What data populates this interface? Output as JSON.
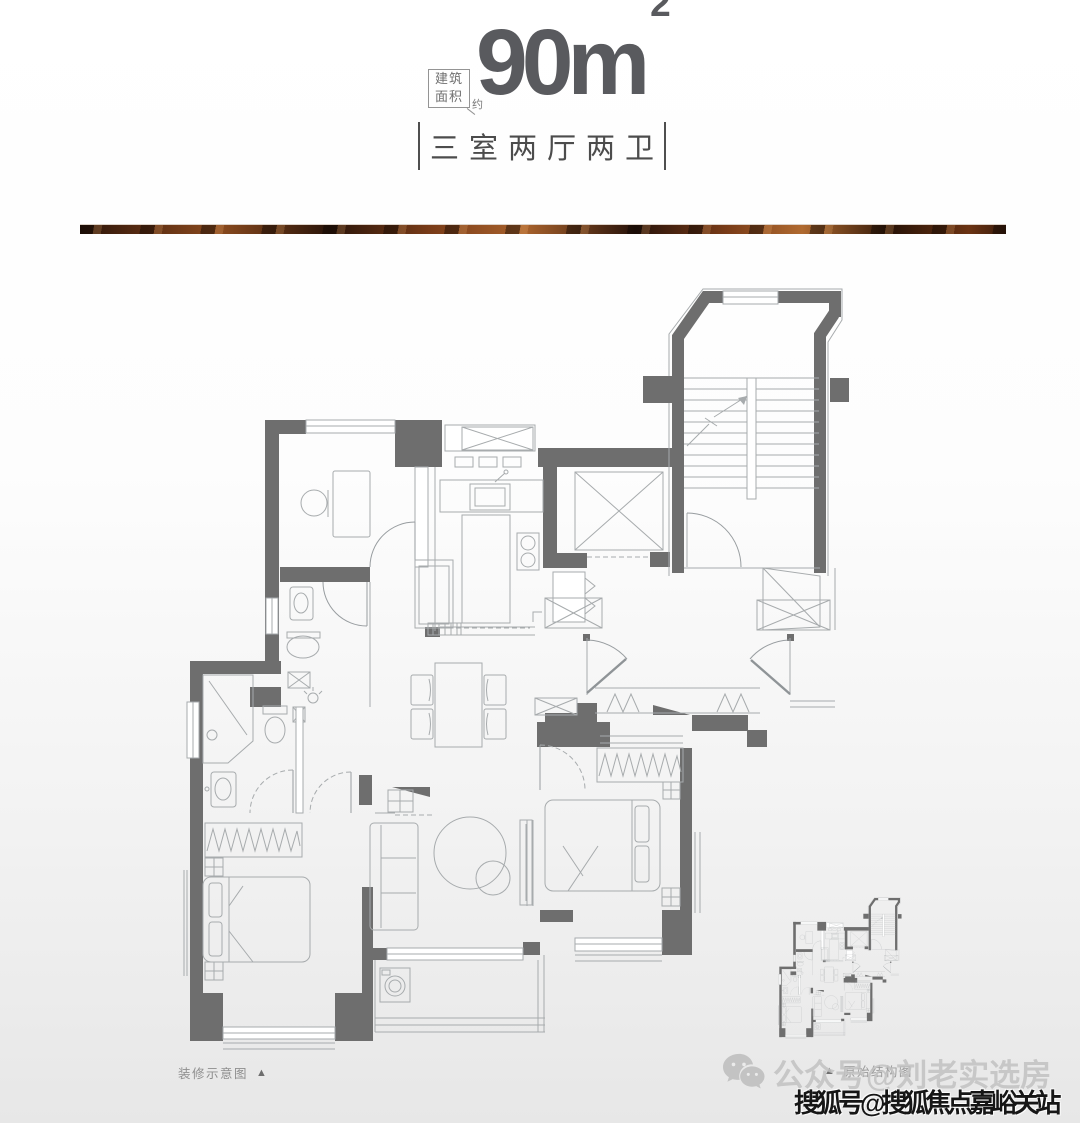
{
  "header": {
    "area_label_line1": "建筑",
    "area_label_line2": "面积",
    "area_label_suffix": "约",
    "area_value": "90m",
    "area_sup": "2",
    "layout_text": "三室两厅两卫"
  },
  "captions": {
    "left_text": "装修示意图",
    "left_marker": "▲",
    "right_marker": "▲",
    "right_text": "原始结构图"
  },
  "watermarks": {
    "wechat_icon": "wechat-icon",
    "wechat_text": "公众号@刘老实选房",
    "sohu_text": "搜狐号@搜狐焦点嘉峪关站"
  },
  "colors": {
    "wall": "#6e6e6e",
    "furniture_line": "#a7abad",
    "copper_dark": "#2a1409",
    "copper_mid": "#7a3c18",
    "copper_light": "#a9622c",
    "title_text": "#595a5e",
    "subtitle_text": "#4c4c4c",
    "caption_text": "#8e8e8e",
    "watermark_light": "#c2c2c2",
    "watermark_dark": "#161616",
    "page_bg_top": "#ffffff",
    "page_bg_bottom": "#e7e7e7"
  }
}
